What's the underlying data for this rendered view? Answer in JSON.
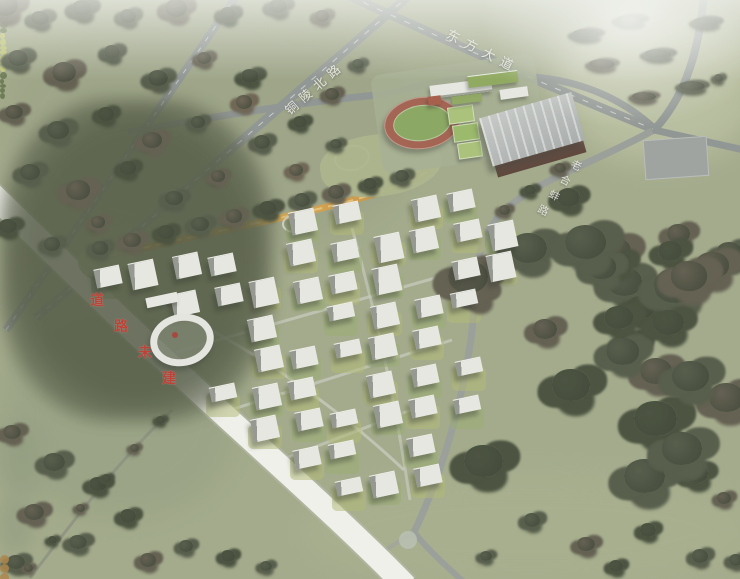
{
  "labels": {
    "tongling_north_road": "铜陵北路",
    "dongfang_avenue": "东方大道",
    "laohebeng_road": "老合蚌路",
    "road_note": "道路未建"
  },
  "palette": {
    "field_green": "#9aa383",
    "forest_green": "#46503a",
    "road_gray": "#8b918f",
    "unbuilt_road_white": "#f3f4ee",
    "note_red": "#bb3327",
    "track_red": "#a05a48",
    "infield_green": "#84a45a",
    "ribbon_orange": "#cf9a43",
    "building_white": "#e9eae5"
  }
}
